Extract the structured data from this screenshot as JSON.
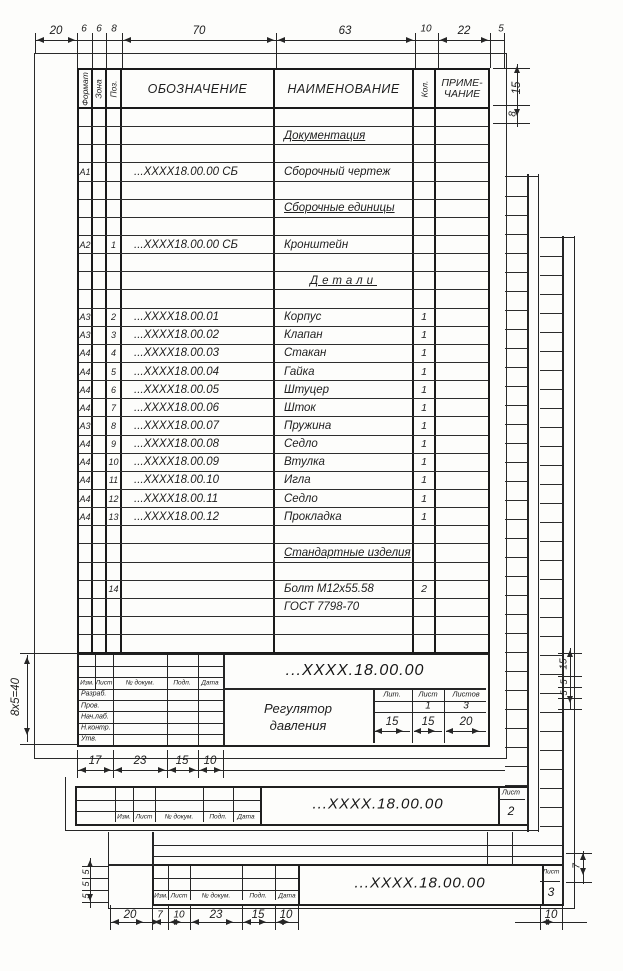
{
  "dims": {
    "top": [
      "20",
      "6",
      "6",
      "8",
      "70",
      "63",
      "10",
      "22",
      "5"
    ],
    "right_header": [
      "15",
      "8"
    ],
    "left_title": "8x5=40",
    "sheet1_bottom": [
      "17",
      "23",
      "15",
      "10"
    ],
    "lit_dims": [
      "15",
      "15",
      "20"
    ],
    "right_strip": [
      "15",
      "5",
      "5"
    ],
    "sheet3_left": [
      "5",
      "5",
      "5"
    ],
    "sheet3_bottom": [
      "20",
      "7",
      "10",
      "23",
      "15",
      "10"
    ],
    "sheet3_right_bottom": "10",
    "sheet3_right_side": "7"
  },
  "table": {
    "headers": {
      "format": "Формат",
      "zone": "Зона",
      "pos": "Поз.",
      "designation": "ОБОЗНАЧЕНИЕ",
      "name": "НАИМЕНОВАНИЕ",
      "qty": "Кол.",
      "note": "ПРИМЕ-ЧАНИЕ"
    },
    "rows": [
      {},
      {
        "n": "Документация",
        "u": true
      },
      {},
      {
        "f": "А1",
        "d": "...ХХХХ18.00.00 СБ",
        "n": "Сборочный чертеж"
      },
      {},
      {
        "n": "Сборочные единицы",
        "u": true
      },
      {},
      {
        "f": "А2",
        "p": "1",
        "d": "...ХХХХ18.00.00 СБ",
        "n": "Кронштейн"
      },
      {},
      {
        "n": "Детали",
        "u": true,
        "c": true
      },
      {},
      {
        "f": "А3",
        "p": "2",
        "d": "...ХХХХ18.00.01",
        "n": "Корпус",
        "q": "1"
      },
      {
        "f": "А3",
        "p": "3",
        "d": "...ХХХХ18.00.02",
        "n": "Клапан",
        "q": "1"
      },
      {
        "f": "А4",
        "p": "4",
        "d": "...ХХХХ18.00.03",
        "n": "Стакан",
        "q": "1"
      },
      {
        "f": "А4",
        "p": "5",
        "d": "...ХХХХ18.00.04",
        "n": "Гайка",
        "q": "1"
      },
      {
        "f": "А4",
        "p": "6",
        "d": "...ХХХХ18.00.05",
        "n": "Штуцер",
        "q": "1"
      },
      {
        "f": "А4",
        "p": "7",
        "d": "...ХХХХ18.00.06",
        "n": "Шток",
        "q": "1"
      },
      {
        "f": "А3",
        "p": "8",
        "d": "...ХХХХ18.00.07",
        "n": "Пружина",
        "q": "1"
      },
      {
        "f": "А4",
        "p": "9",
        "d": "...ХХХХ18.00.08",
        "n": "Седло",
        "q": "1"
      },
      {
        "f": "А4",
        "p": "10",
        "d": "...ХХХХ18.00.09",
        "n": "Втулка",
        "q": "1"
      },
      {
        "f": "А4",
        "p": "11",
        "d": "...ХХХХ18.00.10",
        "n": "Игла",
        "q": "1"
      },
      {
        "f": "А4",
        "p": "12",
        "d": "...ХХХХ18.00.11",
        "n": "Седло",
        "q": "1"
      },
      {
        "f": "А4",
        "p": "13",
        "d": "...ХХХХ18.00.12",
        "n": "Прокладка",
        "q": "1"
      },
      {},
      {
        "n": "Стандартные изделия",
        "u": true
      },
      {},
      {
        "p": "14",
        "n": "Болт М12х55.58",
        "q": "2"
      },
      {
        "n": "ГОСТ 7798-70"
      },
      {},
      {}
    ]
  },
  "title_block": {
    "designation": "...ХХХХ.18.00.00",
    "product_title": "Регулятор давления",
    "change_cols": [
      "Изм.",
      "Лист",
      "№ докум.",
      "Подп.",
      "Дата"
    ],
    "sign_rows": [
      "Разраб.",
      "Пров.",
      "Нач.лаб.",
      "Н.контр.",
      "Утв."
    ],
    "lit_cols": [
      "Лит.",
      "Лист",
      "Листов"
    ],
    "lit_values": {
      "lit": "",
      "list": "1",
      "listov": "3"
    }
  },
  "sheet2_stamp": {
    "change_cols": [
      "Изм.",
      "Лист",
      "№ докум.",
      "Подп.",
      "Дата"
    ],
    "designation": "...ХХХХ.18.00.00",
    "sheet_label": "Лист",
    "sheet_value": "2"
  },
  "sheet3_stamp": {
    "change_cols": [
      "Изм.",
      "Лист",
      "№ докум.",
      "Подп.",
      "Дата"
    ],
    "designation": "...ХХХХ.18.00.00",
    "sheet_label": "Лист",
    "sheet_value": "3"
  }
}
